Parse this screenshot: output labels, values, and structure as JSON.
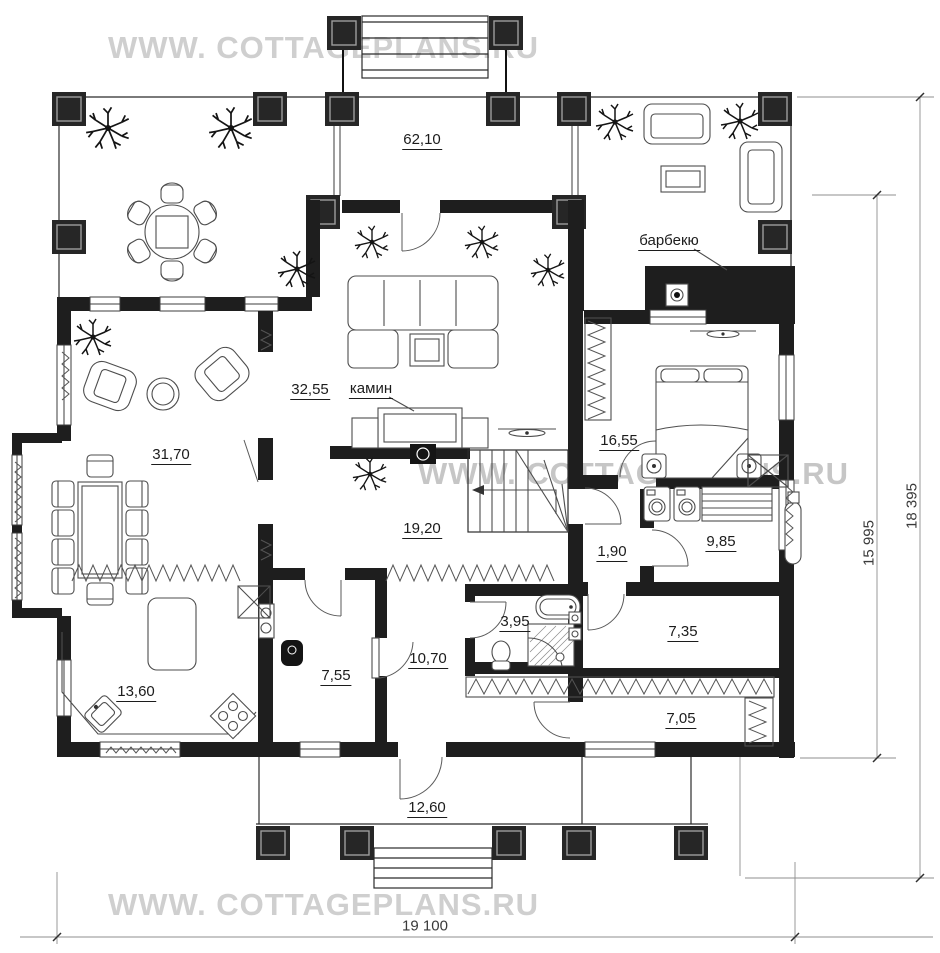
{
  "watermark": {
    "text": "WWW. COTTAGEPLANS.RU"
  },
  "rooms": {
    "terrace": "62,10",
    "living_room": "32,55",
    "dining_room": "31,70",
    "bedroom": "16,55",
    "hall": "19,20",
    "corridor": "1,90",
    "utility_room": "9,85",
    "bathroom": "3,95",
    "cabinet": "7,35",
    "entrance_hall": "10,70",
    "boiler_room": "7,55",
    "kitchen": "13,60",
    "wardrobe": "7,05",
    "veranda": "12,60"
  },
  "callouts": {
    "barbecue": "барбекю",
    "fireplace": "камин"
  },
  "dimensions": {
    "overall_width": "19 100",
    "inner_height": "15 995",
    "overall_height": "18 395"
  }
}
